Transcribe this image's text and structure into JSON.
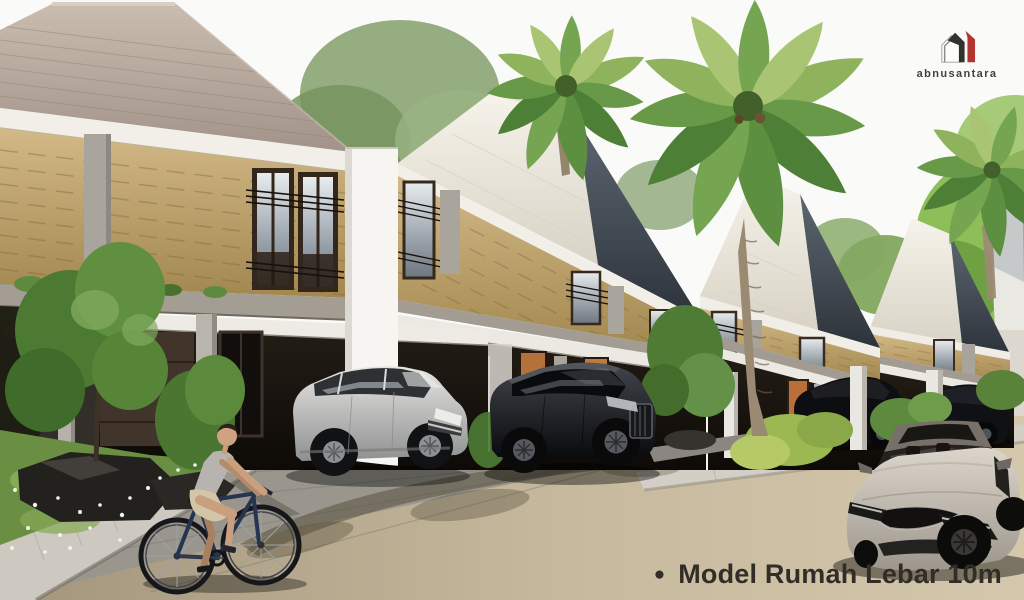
{
  "watermark": {
    "brand": "abnusantara"
  },
  "caption": {
    "bullet": "●",
    "text": "Model Rumah Lebar 10m"
  },
  "scene": {
    "type": "architectural-render",
    "subject": "row of modern two-story houses with carports, palm trees, parked cars, a silver sedan and a cyclist",
    "objects": [
      "house-row",
      "stone-clad-walls",
      "carports",
      "palm-trees",
      "silver-suv",
      "black-suv",
      "distant-parked-cars",
      "silver-sedan",
      "cyclist",
      "garden-rocks",
      "road",
      "sidewalk"
    ]
  },
  "palette": {
    "sky": "#fafaf8",
    "roof_front": "#b3a497",
    "roof_dark": "#343b43",
    "roof_light": "#efece3",
    "stone_wall": "#c2a878",
    "wall_white": "#f4f3f0",
    "road": "#c3b59a",
    "driveway": "#98948c",
    "foliage": "#6f9b4c",
    "logo_red": "#b23430",
    "text": "#322d27"
  }
}
